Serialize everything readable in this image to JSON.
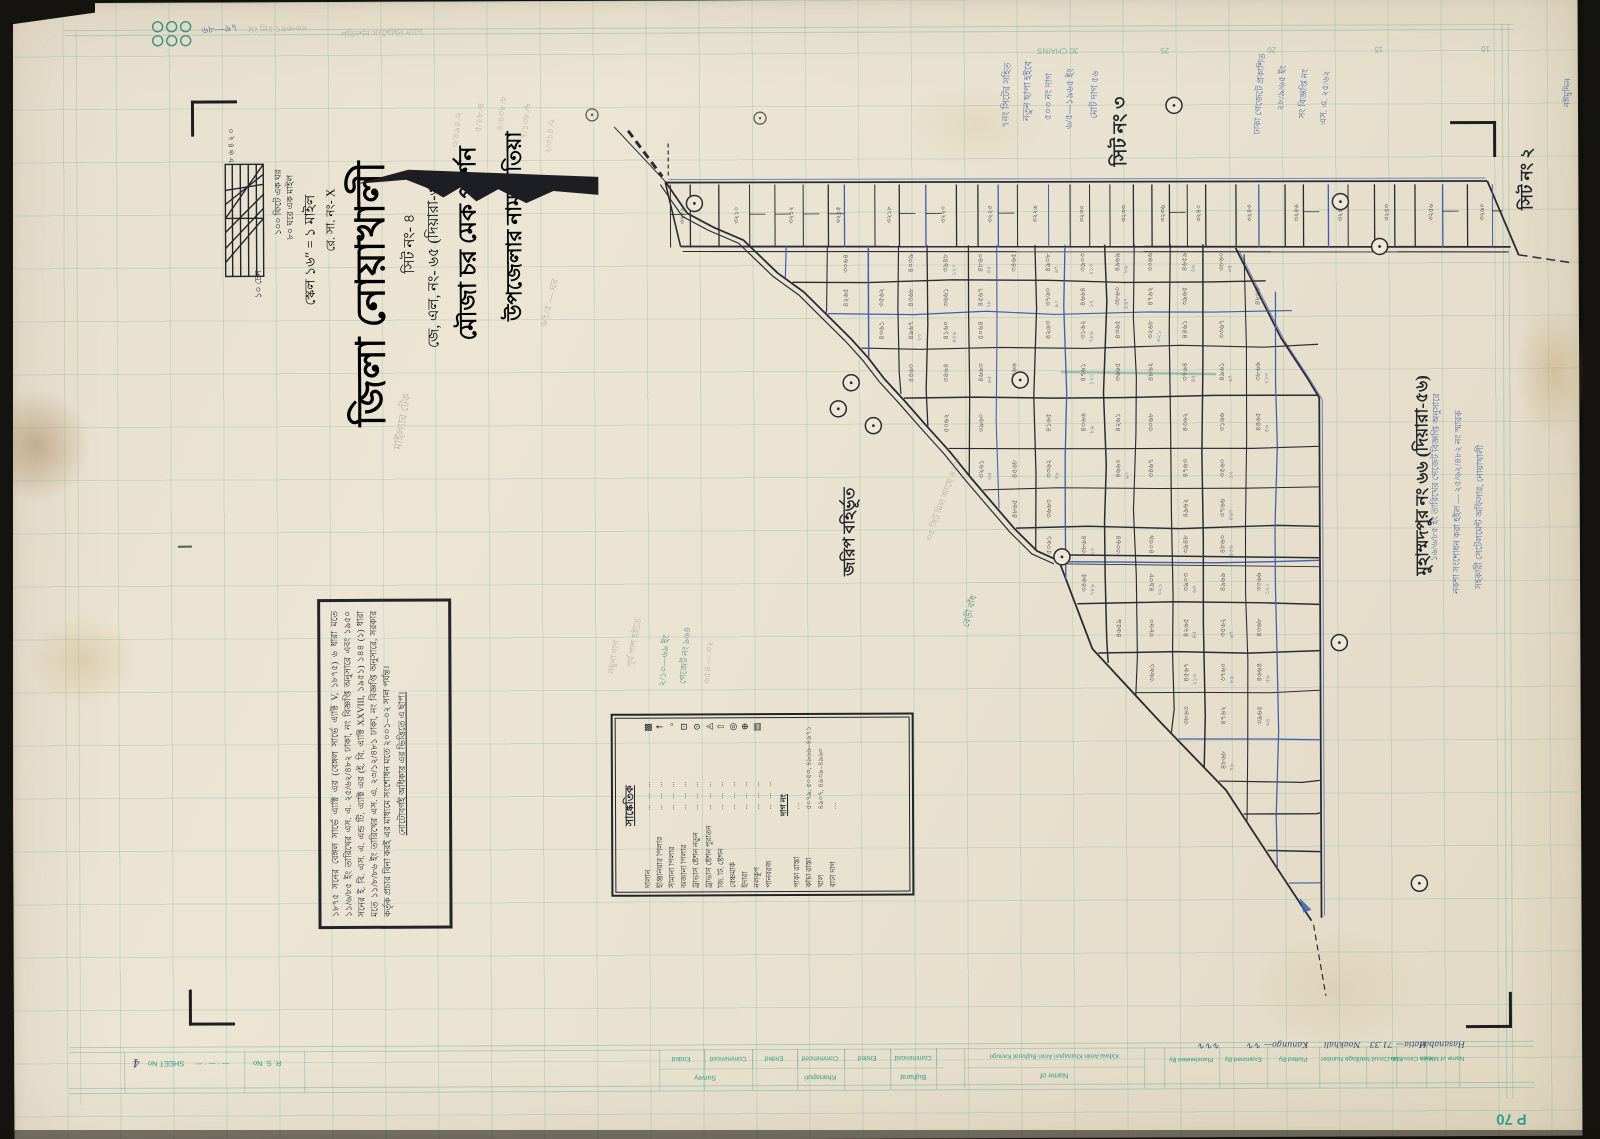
{
  "title_block": {
    "upazila_line": "উপজেলার নাম হাতিয়া",
    "mouza_line": "মৌজা চর মেক পার্শন",
    "jl_line": "জে, এল, নং- ৬৫ (দিয়ারা-৩৩)",
    "sheet_line": "সিট নং- ৪",
    "district_line": "জিলা নোয়াখালী",
    "rs_line": "রে. সা. নং- X",
    "scale_line": "স্কেল ১৬″ = ১ মাইল"
  },
  "scale_bar": {
    "right_label_1": "১০০ ফিটে এক ঘর",
    "right_label_2": "৮০ ঘরে এক মাইল",
    "bottom_label": "১০ চেন",
    "tick_labels": "৮ ৬ ৪ ২ ০"
  },
  "neighbor_labels": {
    "top_sheet": "সিট নং ৩",
    "corner_sheet": "সিট নং ২",
    "east_mouza": "মুহাম্মদপুর নং ৬৬ (দিয়ারা-৫৬)",
    "outside_survey": "জরিপ বহির্ভূত"
  },
  "chain_scale": [
    "30 CHAINS",
    "25",
    "20",
    "15",
    "10"
  ],
  "note_box": {
    "text": "১৮৭৫ সনের বেঙ্গল সার্ভে এ্যাক্ট এর (বেঙ্গল সার্ভে এ্যাক্ট V, ১৮৭৫) ৬ ধারা মতে ১১/৬/৮৫ ইং তারিখের এস. এ. ২৫/৬২/৪৮২ ঢাকা, নং বিজ্ঞপ্তি অনুসারে এবং ১৯৫০ সনের ই. বি. এস. এ. এন্ড টি. এ্যাক্ট এর (ই. বি. এ্যাক্ট XXVIII, ১৯৫১) ১৪৪ (১) ধারা মতে ১১/৮/৮৬ ইং তারিখের এস. এ. ২৩/১২/৪৮১ ঢাকা, নং বিজ্ঞপ্তি অনুসারে, সরকার কর্তৃক প্রচার বিনা করই এর মাধ্যমে সংশোধন মতে ২০০১–০২ সাল পর্যন্ত।",
    "footer": "নোটোবর্গই অধিকার এর ভিত্তিতে এ ছাপ।"
  },
  "legend": {
    "title": "সাঙ্কেতিক",
    "items": [
      {
        "name": "দালান",
        "symbol": "hatched-rect"
      },
      {
        "name": "ইঞ্জিনিয়ার পিলার",
        "symbol": "pillar-cross"
      },
      {
        "name": "সীমানা পিলার",
        "symbol": "small-square"
      },
      {
        "name": "অজানা পিলার",
        "symbol": "small-dot-square"
      },
      {
        "name": "ট্রাভার্স ষ্টেশন নতুন",
        "symbol": "circle-dot"
      },
      {
        "name": "ট্রাভার্স ষ্টেশন পুরাতন",
        "symbol": "triangle-dot"
      },
      {
        "name": "জি. টি. ষ্টেশন",
        "symbol": "arrow-up"
      },
      {
        "name": "বেঞ্চমার্ক",
        "symbol": "double-circle"
      },
      {
        "name": "ইদারা",
        "symbol": "circle-plus"
      },
      {
        "name": "নলকূপ",
        "symbol": "hatched-box"
      },
      {
        "name": "পানবরজ",
        "symbol": "none"
      }
    ],
    "dag_header": "দাগ নং",
    "dag_rows": [
      {
        "name": "পাকা রাস্তা",
        "numbers": "…"
      },
      {
        "name": "কাঁচা রাস্তা",
        "numbers": "৫০৭৯, ৫০৫৩, ৪৯৬৯–৪৯৭১"
      },
      {
        "name": "খাল",
        "numbers": "৪৯০৭, ৪৯৩৯–৪৯৬০"
      },
      {
        "name": "বাটা দাগ",
        "numbers": "…"
      }
    ]
  },
  "map": {
    "plot_numbers": [
      "৩০৬৪",
      "৪০৩৯",
      "৩৯৪৮",
      "৪৮৬০",
      "৩৪৬৫",
      "৪৯০৮",
      "৩৯০৩",
      "৪৯৬৯",
      "৩০৬৬",
      "৪৬৫৯",
      "৩৮৬০",
      "৪২৬৫",
      "৩৫৬২",
      "৪৩৬৮",
      "৩৬৬১",
      "৪৫৬৭",
      "৩৭৬০",
      "৪৬৬৪",
      "৩৮৬৩",
      "৪৭৬২",
      "৩৯৬৫",
      "৪৮৬৮",
      "৪০৬১",
      "৪৯৬৭",
      "৪১৬০",
      "৫০৬৪",
      "৪২৬৩",
      "৩১৬২",
      "৪৩৬৫",
      "৩২৬৮",
      "৪৪৬১",
      "৩৩৬৭",
      "৪৫৬০",
      "৩৪৬৪",
      "৪৬৬৩",
      "৩৫৬৬",
      "৪৭৬১",
      "৩৬৬৫",
      "৪৮৬২",
      "৩৭৬৪",
      "৪৯৬১",
      "৩৮৬৬",
      "৫০৬২",
      "৩৯৬০",
      "৪১৬৫",
      "৪০৬৬",
      "৪২৬১",
      "৩০৬৮",
      "৪৩৬২",
      "৩১৬৬",
      "৪৪৬৫",
      "৩২৬১",
      "৪৫৬৮",
      "৩৩৬২",
      "৪৬৬০",
      "৩৪৬৭",
      "৪৭৬৩",
      "৩৫৬০",
      "৪৮৬৫",
      "৩৬৬৩",
      "৪৯৬২",
      "৩৭৬৬",
      "৫০৬১",
      "৩৮৬৪"
    ],
    "plot_numbers_blue": [
      "১২০",
      "৪৫",
      "৬৭",
      "২১৩",
      "৮৯",
      "৫৬",
      "৩৪",
      "৭৮",
      "৯০",
      "১২",
      "৫৬৭",
      "২৩",
      "৪৫৬",
      "৭৮৯",
      "৩২১",
      "৬৫"
    ],
    "strip_numbers": [
      "৩২০৯",
      "৩২১০",
      "৩২১২",
      "৩২১৫",
      "৩২১৮",
      "৩২২০",
      "৩২২৩",
      "৩২২৬",
      "৩২৩০",
      "৩২৩৩",
      "৩২৩৬",
      "৩২৪০",
      "৩২৪৩",
      "৩২৪৬",
      "৩২৫০",
      "৩২৫৩",
      "৩২৫৬",
      "৩২৬০",
      "৩২৬৩",
      "৩২৬৬",
      "৩২৭০",
      "৩২৭৩",
      "৩২৭৬",
      "৩২৮০"
    ]
  },
  "annotations": [
    {
      "text": "৬৮—৯৭",
      "x": 210,
      "y": 28,
      "rot": -4,
      "color": "blue",
      "size": 10
    },
    {
      "text": "সং নিঃ ১৯৬-৬৯",
      "x": 268,
      "y": 27,
      "rot": -3,
      "color": "pencil",
      "size": 9
    },
    {
      "text": "পরিদর্শন সংশোধন ম্যাপ",
      "x": 372,
      "y": 32,
      "rot": -2,
      "color": "pencil",
      "size": 9
    },
    {
      "text": "৩/৪৯৪ ∕২",
      "x": 447,
      "y": 128,
      "rot": -83,
      "color": "pencil",
      "size": 9
    },
    {
      "text": "৫/২৮ ∕৪",
      "x": 470,
      "y": 116,
      "rot": -83,
      "color": "pencil",
      "size": 9
    },
    {
      "text": "৪/৪৩৮ ∕৮",
      "x": 492,
      "y": 112,
      "rot": -83,
      "color": "pencil",
      "size": 9
    },
    {
      "text": "৭/১৩৮ ∕৬",
      "x": 516,
      "y": 120,
      "rot": -83,
      "color": "pencil",
      "size": 9
    },
    {
      "text": "২/৩১৪ ∕২",
      "x": 540,
      "y": 135,
      "rot": -83,
      "color": "pencil",
      "size": 9
    },
    {
      "text": "৭নং সিটের সহিত",
      "x": 998,
      "y": 96,
      "rot": -88,
      "color": "blue",
      "size": 9.5
    },
    {
      "text": "নতুন ছাপা হইবে",
      "x": 1019,
      "y": 92,
      "rot": -88,
      "color": "blue",
      "size": 9.5
    },
    {
      "text": "৫০৩ নং দাগ",
      "x": 1040,
      "y": 98,
      "rot": -88,
      "color": "blue",
      "size": 9.5
    },
    {
      "text": "৬/৫—১৯৬৫ ইং",
      "x": 1061,
      "y": 100,
      "rot": -88,
      "color": "blue",
      "size": 9.5
    },
    {
      "text": "মোট দাগ ৫৬",
      "x": 1086,
      "y": 96,
      "rot": -88,
      "color": "blue",
      "size": 9.5
    },
    {
      "text": "ঢাকা গেজেটে প্রকাশিত",
      "x": 1250,
      "y": 96,
      "rot": -86,
      "color": "blue",
      "size": 9
    },
    {
      "text": "২৮/৯/৬৫ ইং",
      "x": 1272,
      "y": 90,
      "rot": -86,
      "color": "blue",
      "size": 9
    },
    {
      "text": "সং বিজ্ঞপ্তি নং",
      "x": 1294,
      "y": 96,
      "rot": -86,
      "color": "blue",
      "size": 9
    },
    {
      "text": "এস. এ. ২৫/৬২",
      "x": 1315,
      "y": 100,
      "rot": -86,
      "color": "blue",
      "size": 9
    },
    {
      "text": "১৬/৬/৮৫ ইং তারিখের গেজেট বিজ্ঞপ্তি অনুসারে",
      "x": 1424,
      "y": 480,
      "rot": -89,
      "color": "blue",
      "size": 9
    },
    {
      "text": "নকশা সংশোধন করা হইল — ২৫/৬২/৪৮২ নং স্মারক",
      "x": 1446,
      "y": 505,
      "rot": -89,
      "color": "blue",
      "size": 9
    },
    {
      "text": "সহকারী সেটেলমেন্ট অফিসার, নোয়াখালী",
      "x": 1468,
      "y": 520,
      "rot": -89,
      "color": "blue",
      "size": 9
    },
    {
      "text": "নঈমুদ্দিন",
      "x": 1558,
      "y": 96,
      "rot": -88,
      "color": "blue",
      "size": 8.5
    },
    {
      "text": "বেড়ী বাঁধ",
      "x": 958,
      "y": 612,
      "rot": -75,
      "color": "teal",
      "size": 9
    },
    {
      "text": "২/১০—৬৯ ইং",
      "x": 652,
      "y": 660,
      "rot": -85,
      "color": "teal",
      "size": 9
    },
    {
      "text": "গেজেট নং ৯৬৪",
      "x": 673,
      "y": 655,
      "rot": -85,
      "color": "teal",
      "size": 9
    },
    {
      "text": "৬৫৪ — ৩২",
      "x": 696,
      "y": 662,
      "rot": -85,
      "color": "pencil",
      "size": 9
    },
    {
      "text": "পূর্ব পাশ হইতে",
      "x": 622,
      "y": 642,
      "rot": -80,
      "color": "pencil",
      "size": 9
    },
    {
      "text": "নমুনা দাগ",
      "x": 602,
      "y": 656,
      "rot": -80,
      "color": "pencil",
      "size": 9
    },
    {
      "text": "মাইল্যার টেক",
      "x": 392,
      "y": 420,
      "rot": -80,
      "color": "pencil",
      "size": 11
    },
    {
      "text": "৬৭/৫ — ঘর",
      "x": 540,
      "y": 302,
      "rot": -75,
      "color": "pencil",
      "size": 10
    },
    {
      "text": "৩৫ সিট মিল আছে ৪২/৩",
      "x": 932,
      "y": 500,
      "rot": -70,
      "color": "pencil",
      "size": 9
    }
  ],
  "bottom_form": {
    "rs_no": "R. S. No",
    "sheet_no": "SHEET No",
    "sheet_no_value": "4",
    "ended": "Ended",
    "commenced": "Commenced",
    "stage_groups": [
      "Survey",
      "Khanapuri",
      "Bujharat"
    ],
    "name_of": "Name of",
    "amins": "Kidwai Amin   Khanapuri Amin   Bujharat Kanugo",
    "right_columns": [
      "Plansheeted By",
      "Examined By",
      "Plotted By",
      "Village Number",
      "Sub Circuit No.",
      "Main Circuit No.",
      "Name of Mauza"
    ],
    "right_values": [
      "Hasanabad",
      "Hatia—",
      "71.33",
      "Noakhali",
      "Kanungo—"
    ],
    "page_number": "P 70"
  }
}
